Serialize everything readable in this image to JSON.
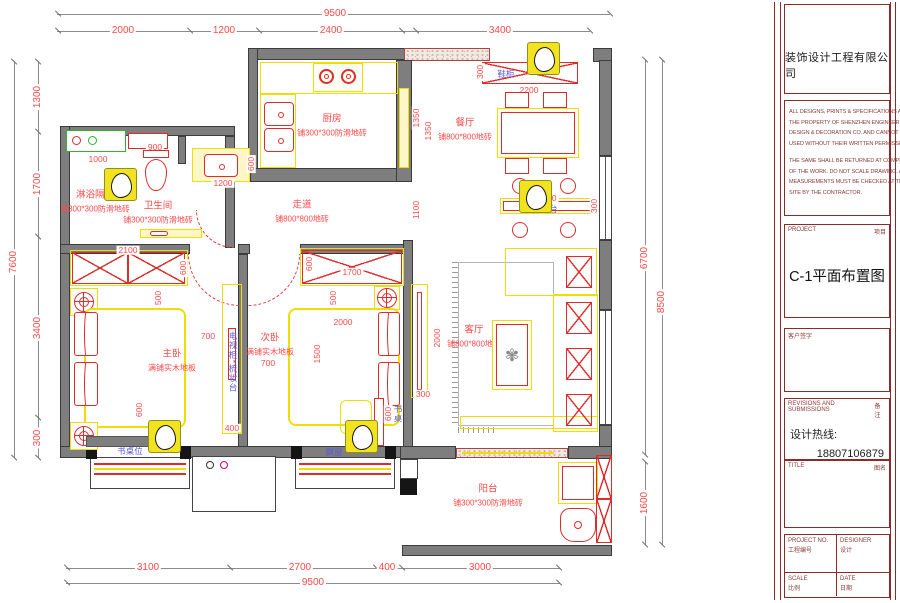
{
  "plan": {
    "rooms": {
      "kitchen": {
        "name": "厨房",
        "floor": "铺300*300防滑地砖"
      },
      "dining": {
        "name": "餐厅",
        "floor": "铺800*800地砖"
      },
      "shower": {
        "name": "淋浴隔断",
        "floor": "铺300*300防滑地砖"
      },
      "bathroom": {
        "name": "卫生间",
        "floor": "铺300*300防滑地砖"
      },
      "corridor": {
        "name": "走道",
        "floor": "铺800*800地砖"
      },
      "master": {
        "name": "主卧",
        "floor": "满铺实木地板"
      },
      "second": {
        "name": "次卧",
        "floor": "满铺实木地板"
      },
      "living": {
        "name": "客厅",
        "floor": "铺800*800地砖"
      },
      "balcony": {
        "name": "阳台",
        "floor": "铺300*300防滑地砖"
      }
    },
    "labels": {
      "desk_spot": "书桌位",
      "bay_window": "飘窗",
      "bar": "吧台",
      "desk": "书桌",
      "tv_dresser": "电视柜*梳妆台",
      "shoe_cabinet": "鞋柜"
    },
    "dims": {
      "top_total": "9500",
      "top_1": "2000",
      "top_2": "1200",
      "top_3": "2400",
      "top_4": "3400",
      "bottom_1": "3100",
      "bottom_2": "2700",
      "bottom_3": "400",
      "bottom_4": "3000",
      "bottom_total": "9500",
      "left_total": "7600",
      "left_1": "1300",
      "left_2": "1700",
      "left_3": "3400",
      "left_4": "300",
      "right_seg": "6700",
      "right_balcony": "1600",
      "right_total": "8500",
      "kitchen_depth": "1350",
      "corridor_width": "1100",
      "vanity": "1000",
      "toilet": "900",
      "basin_w": "1200",
      "basin_d": "600",
      "dining_wall": "1350",
      "cabinet_w": "2200",
      "cabinet_d": "300",
      "bar_w": "1800",
      "bar_d": "300",
      "m_wardrobe": "2100",
      "m_wardrobe_d": "600",
      "m_gap": "500",
      "m_side": "700",
      "m_foot": "600",
      "m_dresser": "400",
      "s_wardrobe": "1700",
      "s_wardrobe_d": "600",
      "s_gap": "500",
      "s_bed_w": "2000",
      "s_bed_l": "1500",
      "s_side": "700",
      "s_desk": "600",
      "tv_len": "2000",
      "tv_d": "300"
    },
    "icons": {
      "plant": "✾"
    }
  },
  "title_block": {
    "company": "装饰设计工程有限公司",
    "disclaimer": [
      "ALL DESIGNS, PRINTS & SPECIFICATIONS ARE",
      "THE PROPERTY OF SHENZHEN ENGINEERING",
      "DESIGN & DECORATION CO. AND CANNOT BE",
      "USED WITHOUT THEIR WRITTEN PERMISSION.",
      "THE SAME SHALL BE RETURNED AT COMPLETION",
      "OF THE WORK. DO NOT SCALE DRAWING. ALL",
      "MEASUREMENTS MUST BE CHECKED AT THE",
      "SITE BY THE CONTRACTOR."
    ],
    "project_en": "PROJECT",
    "project_cn": "项目",
    "drawing_name": "C-1平面布置图",
    "client_sign": "客户签字",
    "revisions_en": "REVISIONS AND SUBMISSIONS",
    "revisions_cn": "备注",
    "hotline_label": "设计热线:",
    "hotline_number": "18807106879",
    "title_en": "TITLE",
    "title_cn": "图名",
    "project_no_en": "PROJECT NO.",
    "project_no_cn": "工程编号",
    "designer_en": "DESIGNER",
    "designer_cn": "设计",
    "scale_en": "SCALE",
    "scale_cn": "比例",
    "date_en": "DATE",
    "date_cn": "日期"
  }
}
